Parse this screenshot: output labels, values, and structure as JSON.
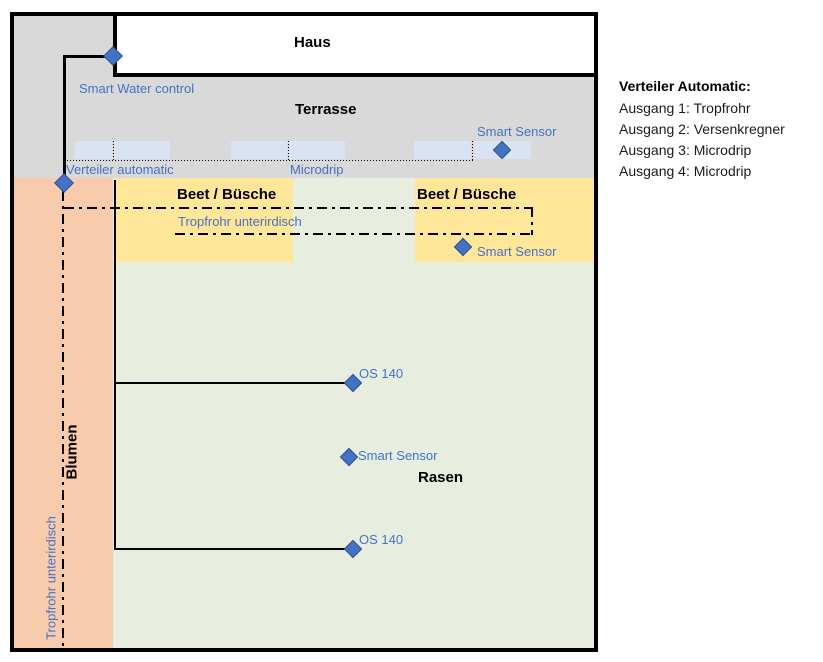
{
  "diagram": {
    "areas": {
      "house": "Haus",
      "terrace": "Terrasse",
      "bed_left": "Beet / Büsche",
      "bed_right": "Beet / Büsche",
      "flowers": "Blumen",
      "lawn": "Rasen"
    },
    "labels": {
      "smart_water_control": "Smart Water control",
      "verteiler_automatic": "Verteiler automatic",
      "microdrip": "Microdrip",
      "smart_sensor_terrace": "Smart Sensor",
      "smart_sensor_bed": "Smart Sensor",
      "smart_sensor_lawn": "Smart Sensor",
      "tropfrohr_unterirdisch_bed": "Tropfrohr unterirdisch",
      "tropfrohr_unterirdisch_flowers": "Tropfrohr unterirdisch",
      "os140_upper": "OS 140",
      "os140_lower": "OS 140"
    },
    "colors": {
      "terrace_gray": "#D9D9D9",
      "bed_yellow": "#FFE699",
      "flowers_orange": "#F8CBAD",
      "lawn_green": "#E7EEDF",
      "microdrip_zone_blue": "#DAE3F3",
      "marker_blue": "#4472C4",
      "label_blue": "#4472C4",
      "line_black": "#000000"
    }
  },
  "legend": {
    "title": "Verteiler Automatic:",
    "items": [
      "Ausgang 1: Tropfrohr",
      "Ausgang 2: Versenkregner",
      "Ausgang 3: Microdrip",
      "Ausgang 4: Microdrip"
    ]
  }
}
